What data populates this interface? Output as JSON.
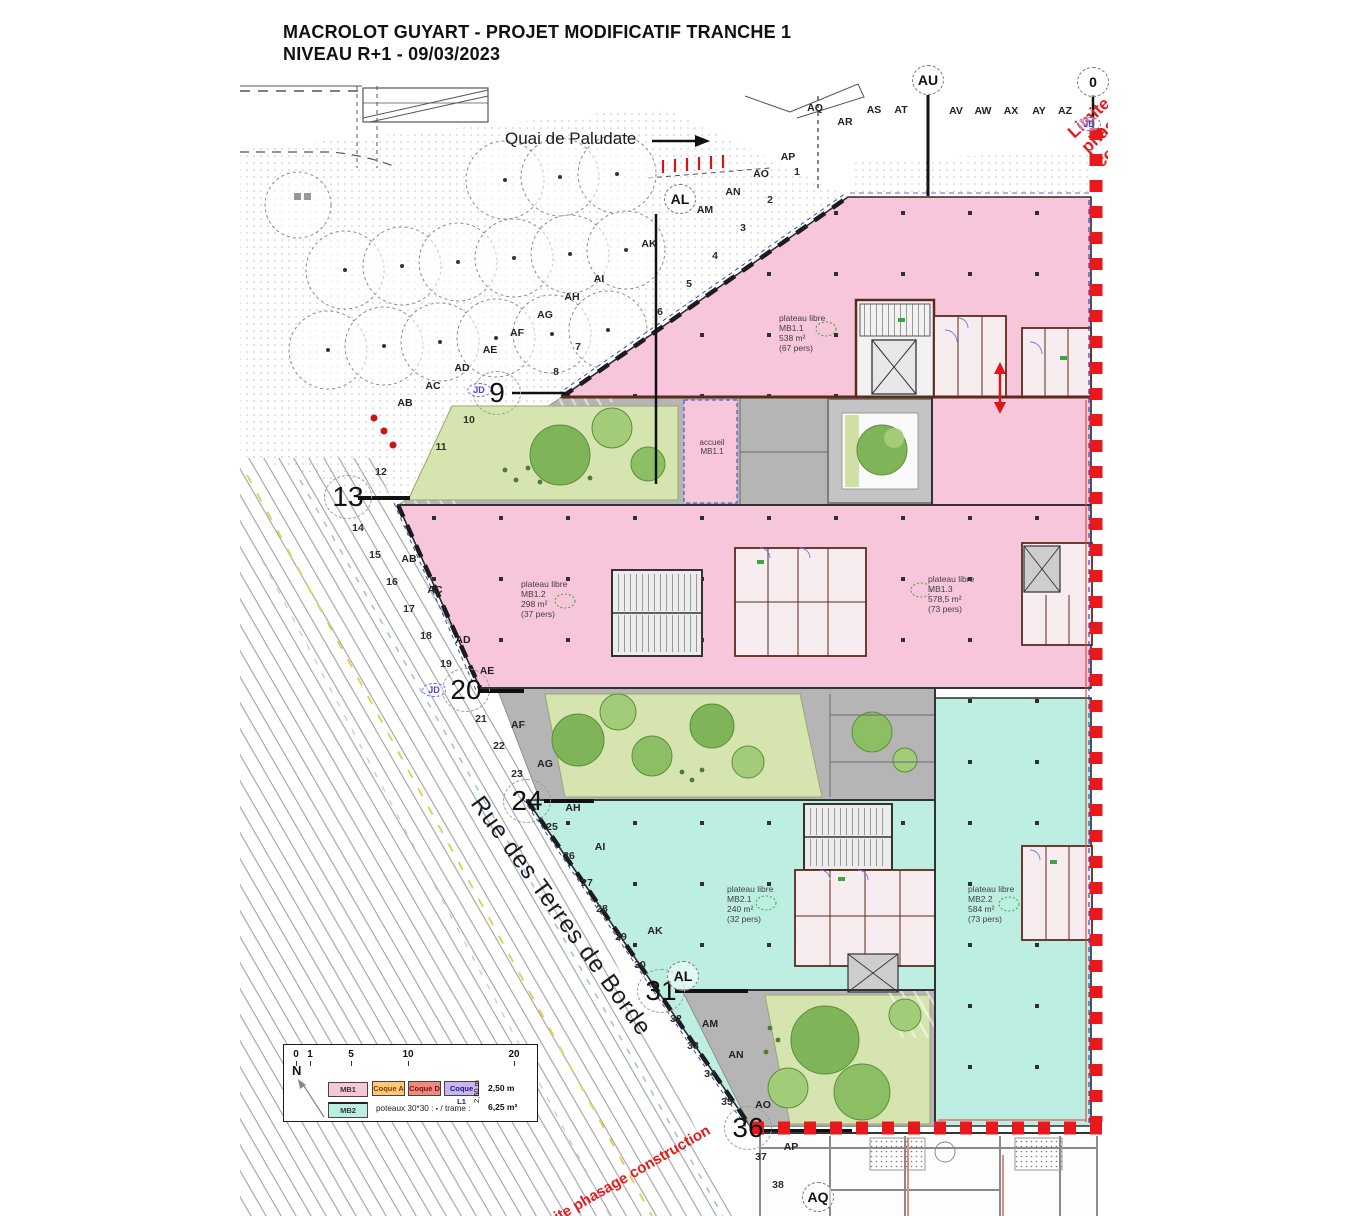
{
  "title": {
    "line1": "MACROLOT GUYART - PROJET MODIFICATIF TRANCHE 1",
    "line2": "NIVEAU R+1 - 09/03/2023"
  },
  "streets": {
    "quai": "Quai de Paludate",
    "rue": "Rue des Terres de Borde"
  },
  "boundary": {
    "label": "Limite phasage construction"
  },
  "zone_label_title": "plateau libre",
  "zones": [
    {
      "id": "MB1.1",
      "area": "538 m²",
      "pers": "(67 pers)",
      "x": 779,
      "y": 313
    },
    {
      "id": "MB1.2",
      "area": "298 m²",
      "pers": "(37 pers)",
      "x": 521,
      "y": 579
    },
    {
      "id": "MB1.3",
      "area": "578,5 m²",
      "pers": "(73 pers)",
      "x": 928,
      "y": 574
    },
    {
      "id": "MB2.1",
      "area": "240 m²",
      "pers": "(32 pers)",
      "x": 727,
      "y": 884
    },
    {
      "id": "MB2.2",
      "area": "584 m²",
      "pers": "(73 pers)",
      "x": 968,
      "y": 884
    }
  ],
  "accueil": {
    "l1": "accueil",
    "l2": "MB1.1"
  },
  "legend": {
    "scale": [
      "0",
      "1",
      "5",
      "10",
      "20"
    ],
    "north": "N",
    "mb1": "MB1",
    "mb2": "MB2",
    "coqueA": "Coque A",
    "coqueD": "Coque D",
    "coqueL1": "Coque L1",
    "poteaux_prefix": "poteaux 30*30 :",
    "square": "▪",
    "trame": "/  trame :",
    "d1": "2,50 m",
    "d2": "6,25 m²",
    "drot": "2,50 m"
  },
  "colors": {
    "mb1": "#f7c6da",
    "mb2": "#bdeee2",
    "coqueA": "#ffc878",
    "coqueD": "#f08a7e",
    "coqueL1": "#c9b6ee",
    "red": "#e8191c",
    "garden": "#d6e5b0",
    "gray": "#b5b5b5",
    "tree1": "#7fb558",
    "tree2": "#a2cc78",
    "tree3": "#8cbf63",
    "wall": "#5d2a1c",
    "blue": "#3344cc"
  },
  "grid": {
    "letters": [
      {
        "t": "AQ",
        "x": 815,
        "y": 108
      },
      {
        "t": "AR",
        "x": 845,
        "y": 122
      },
      {
        "t": "AS",
        "x": 874,
        "y": 110
      },
      {
        "t": "AT",
        "x": 901,
        "y": 110
      },
      {
        "t": "AV",
        "x": 956,
        "y": 111
      },
      {
        "t": "AW",
        "x": 983,
        "y": 111
      },
      {
        "t": "AX",
        "x": 1011,
        "y": 111
      },
      {
        "t": "AY",
        "x": 1039,
        "y": 111
      },
      {
        "t": "AZ",
        "x": 1065,
        "y": 111
      },
      {
        "t": "AB",
        "x": 405,
        "y": 403
      },
      {
        "t": "AC",
        "x": 433,
        "y": 386
      },
      {
        "t": "AD",
        "x": 462,
        "y": 368
      },
      {
        "t": "AE",
        "x": 490,
        "y": 350
      },
      {
        "t": "AF",
        "x": 517,
        "y": 333
      },
      {
        "t": "AG",
        "x": 545,
        "y": 315
      },
      {
        "t": "AH",
        "x": 572,
        "y": 297
      },
      {
        "t": "AI",
        "x": 599,
        "y": 279
      },
      {
        "t": "AK",
        "x": 649,
        "y": 244
      },
      {
        "t": "AM",
        "x": 705,
        "y": 210
      },
      {
        "t": "AN",
        "x": 733,
        "y": 192
      },
      {
        "t": "AO",
        "x": 761,
        "y": 174
      },
      {
        "t": "AP",
        "x": 788,
        "y": 157
      },
      {
        "t": "AB",
        "x": 409,
        "y": 559
      },
      {
        "t": "AC",
        "x": 435,
        "y": 590
      },
      {
        "t": "AD",
        "x": 463,
        "y": 640
      },
      {
        "t": "AE",
        "x": 487,
        "y": 671
      },
      {
        "t": "AF",
        "x": 518,
        "y": 725
      },
      {
        "t": "AG",
        "x": 545,
        "y": 764
      },
      {
        "t": "AH",
        "x": 573,
        "y": 808
      },
      {
        "t": "AI",
        "x": 600,
        "y": 847
      },
      {
        "t": "AK",
        "x": 655,
        "y": 931
      },
      {
        "t": "AM",
        "x": 710,
        "y": 1024
      },
      {
        "t": "AN",
        "x": 736,
        "y": 1055
      },
      {
        "t": "AO",
        "x": 763,
        "y": 1105
      },
      {
        "t": "AP",
        "x": 791,
        "y": 1147
      }
    ],
    "numbers": [
      {
        "t": "1",
        "x": 797,
        "y": 172
      },
      {
        "t": "2",
        "x": 770,
        "y": 200
      },
      {
        "t": "3",
        "x": 743,
        "y": 228
      },
      {
        "t": "4",
        "x": 715,
        "y": 256
      },
      {
        "t": "5",
        "x": 689,
        "y": 284
      },
      {
        "t": "6",
        "x": 660,
        "y": 312
      },
      {
        "t": "7",
        "x": 578,
        "y": 347
      },
      {
        "t": "8",
        "x": 556,
        "y": 372
      },
      {
        "t": "10",
        "x": 469,
        "y": 420
      },
      {
        "t": "11",
        "x": 441,
        "y": 447
      },
      {
        "t": "12",
        "x": 381,
        "y": 472
      },
      {
        "t": "14",
        "x": 358,
        "y": 528
      },
      {
        "t": "15",
        "x": 375,
        "y": 555
      },
      {
        "t": "16",
        "x": 392,
        "y": 582
      },
      {
        "t": "17",
        "x": 409,
        "y": 609
      },
      {
        "t": "18",
        "x": 426,
        "y": 636
      },
      {
        "t": "19",
        "x": 446,
        "y": 664
      },
      {
        "t": "21",
        "x": 481,
        "y": 719
      },
      {
        "t": "22",
        "x": 499,
        "y": 746
      },
      {
        "t": "23",
        "x": 517,
        "y": 774
      },
      {
        "t": "25",
        "x": 552,
        "y": 827
      },
      {
        "t": "26",
        "x": 569,
        "y": 856
      },
      {
        "t": "27",
        "x": 587,
        "y": 883
      },
      {
        "t": "28",
        "x": 602,
        "y": 909
      },
      {
        "t": "29",
        "x": 621,
        "y": 937
      },
      {
        "t": "30",
        "x": 640,
        "y": 965
      },
      {
        "t": "32",
        "x": 676,
        "y": 1019
      },
      {
        "t": "33",
        "x": 693,
        "y": 1046
      },
      {
        "t": "34",
        "x": 710,
        "y": 1074
      },
      {
        "t": "35",
        "x": 727,
        "y": 1102
      },
      {
        "t": "37",
        "x": 761,
        "y": 1157
      },
      {
        "t": "38",
        "x": 778,
        "y": 1185
      }
    ],
    "big": [
      {
        "t": "9",
        "x": 497,
        "y": 393
      },
      {
        "t": "13",
        "x": 348,
        "y": 497
      },
      {
        "t": "20",
        "x": 466,
        "y": 690
      },
      {
        "t": "24",
        "x": 527,
        "y": 801
      },
      {
        "t": "31",
        "x": 661,
        "y": 991
      },
      {
        "t": "36",
        "x": 748,
        "y": 1128
      }
    ],
    "circled": [
      {
        "t": "AU",
        "x": 928,
        "y": 80
      },
      {
        "t": "0",
        "x": 1093,
        "y": 82
      },
      {
        "t": "AL",
        "x": 680,
        "y": 199
      },
      {
        "t": "AL",
        "x": 683,
        "y": 976
      },
      {
        "t": "AQ",
        "x": 818,
        "y": 1197
      }
    ]
  },
  "markers": {
    "jd": "JD",
    "jd_positions": [
      {
        "x": 479,
        "y": 390
      },
      {
        "x": 434,
        "y": 690
      },
      {
        "x": 1089,
        "y": 124
      }
    ]
  }
}
